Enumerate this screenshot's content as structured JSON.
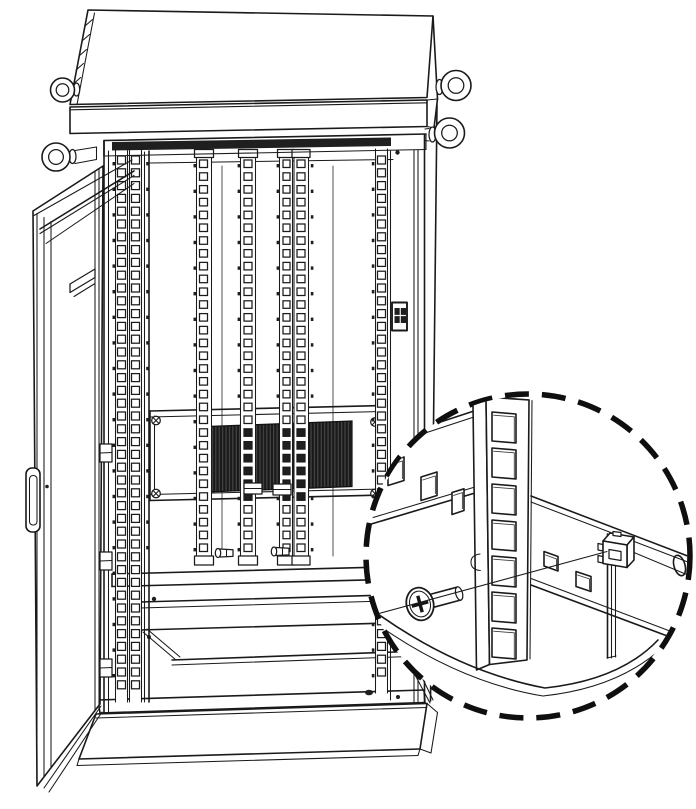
{
  "meta": {
    "type": "technical-line-illustration",
    "description": "Outdoor equipment rack cabinet with open front door, square-hole mounting rails, ventilation grille, lifting eye bolts and base plinth; a dashed-circle magnified callout shows a pan-head screw being installed through a square-hole rack rail into a cage nut",
    "text_content": "none - the drawing contains no text"
  },
  "palette": {
    "background": "#ffffff",
    "line": "#1a1a1a",
    "line_soft": "#3d3d3d",
    "dark_fill": "#1f1f1f",
    "vent_base": "#191919",
    "vent_stripe": "#4a4a4a"
  },
  "cabinet": {
    "dark_header_strip": "112,142 391,137.5 391,146 112,150.5",
    "vent": {
      "points": "207,426.5 352,421 352,486.5 207,492",
      "bounds": {
        "x1": 205,
        "x2": 355,
        "y1": 420,
        "y2": 495
      }
    },
    "hole_strips": [
      {
        "name": "left-frame-a",
        "x": 117.5,
        "w": 8,
        "h": 8,
        "y0": 156,
        "y1": 697,
        "pitch": 12.8,
        "lines": [
          115.5,
          127.5
        ]
      },
      {
        "name": "left-frame-b",
        "x": 131.5,
        "w": 8,
        "h": 8,
        "y0": 156,
        "y1": 697,
        "pitch": 12.8,
        "lines": [
          129.5,
          141.5
        ]
      },
      {
        "name": "rail-1",
        "x": 199.5,
        "w": 8,
        "h": 7.5,
        "y0": 160,
        "y1": 553,
        "pitch": 12.8,
        "lines": [
          196.5,
          211.5
        ]
      },
      {
        "name": "rail-2",
        "x": 244,
        "w": 8,
        "h": 7.5,
        "y0": 160,
        "y1": 553,
        "pitch": 12.8,
        "lines": [
          240.5,
          255.5
        ]
      },
      {
        "name": "rail-3",
        "x": 283,
        "w": 7,
        "h": 7.5,
        "y0": 160,
        "y1": 553,
        "pitch": 12.8,
        "lines": [
          279.5,
          292.5
        ]
      },
      {
        "name": "rail-4",
        "x": 297,
        "w": 8,
        "h": 7.5,
        "y0": 160,
        "y1": 553,
        "pitch": 12.8,
        "lines": [
          294,
          308.5
        ]
      },
      {
        "name": "right-frame",
        "x": 377.5,
        "w": 8,
        "h": 8,
        "y0": 156,
        "y1": 688,
        "pitch": 12.8,
        "lines": [
          375.5,
          387.5
        ]
      }
    ],
    "dot_pitch": 25.6,
    "dot_columns": [
      {
        "x": 112.5,
        "y0": 162,
        "y1": 694
      },
      {
        "x": 146.2,
        "y0": 162,
        "y1": 556
      },
      {
        "x": 193.5,
        "y0": 164,
        "y1": 550
      },
      {
        "x": 237.6,
        "y0": 164,
        "y1": 550
      },
      {
        "x": 276.6,
        "y0": 164,
        "y1": 550
      },
      {
        "x": 310.8,
        "y0": 164,
        "y1": 550
      },
      {
        "x": 371.8,
        "y0": 162,
        "y1": 684
      }
    ]
  },
  "callout": {
    "cx": 528,
    "cy": 556,
    "r": 162,
    "stroke_width": 5.5,
    "dash": "24 13",
    "detail_holes": {
      "x": 492,
      "width": 24,
      "height": 29,
      "skew": 2,
      "tops": [
        412,
        448,
        484,
        520,
        556,
        592,
        628
      ]
    }
  },
  "components": [
    "sloped rain roof with hatched edge",
    "four lifting eye bolts",
    "open front door with handle, hinges and stay bars",
    "vertical 19-inch mounting rails with square holes",
    "dark ventilation grille behind rails",
    "equipment panel frame with corner screws",
    "lower shelf and bottom cross members",
    "base plinth",
    "door latch block",
    "callout: rack rail, pan-head screw, screw axis line, cage nut"
  ]
}
